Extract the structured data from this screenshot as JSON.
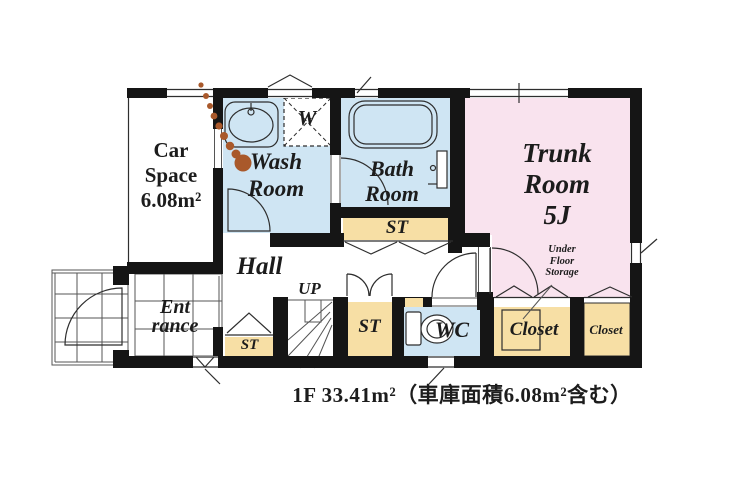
{
  "title": "1F floor plan",
  "caption": "1F 33.41m²（車庫面積6.08m²含む）",
  "rooms": {
    "car_space": {
      "line1": "Car",
      "line2": "Space",
      "line3": "6.08m²"
    },
    "wash_room": {
      "line1": "Wash",
      "line2": "Room"
    },
    "washing_machine": {
      "label": "W"
    },
    "bath_room": {
      "line1": "Bath",
      "line2": "Room"
    },
    "trunk_room": {
      "line1": "Trunk",
      "line2": "Room",
      "line3": "5J"
    },
    "hall": {
      "label": "Hall"
    },
    "stairs": {
      "label": "UP"
    },
    "entrance": {
      "line1": "Ent",
      "line2": "rance"
    },
    "storage_main": {
      "label": "ST"
    },
    "storage_hall": {
      "label": "ST"
    },
    "storage_entrance": {
      "label": "ST"
    },
    "wc": {
      "label": "WC"
    },
    "closet_1": {
      "label": "Closet"
    },
    "closet_2": {
      "label": "Closet"
    },
    "under_floor_storage": {
      "line1": "Under",
      "line2": "Floor",
      "line3": "Storage"
    }
  },
  "colors": {
    "wet": "#cfe5f3",
    "st": "#f7dfa5",
    "trunk": "#f9e3ee",
    "wall": "#151515",
    "dot": "#a9592b",
    "ink": "#1c1c1c"
  }
}
